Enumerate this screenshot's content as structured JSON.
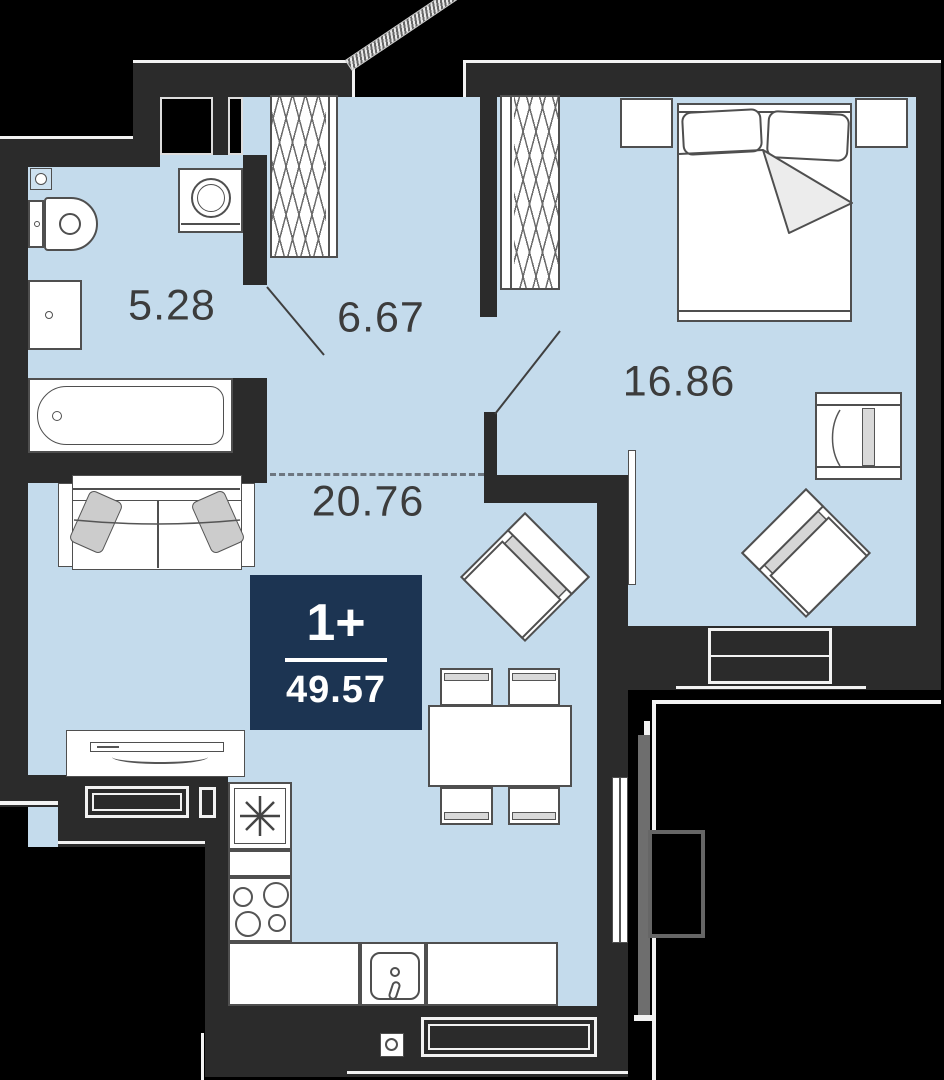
{
  "plan": {
    "badge": {
      "type": "1+",
      "area": "49.57"
    },
    "rooms": [
      {
        "id": "bathroom",
        "area": "5.28"
      },
      {
        "id": "hallway",
        "area": "6.67"
      },
      {
        "id": "bedroom",
        "area": "16.86"
      },
      {
        "id": "living-kitchen",
        "area": "20.76"
      }
    ],
    "colors": {
      "background": "#000000",
      "wall": "#2b2b2b",
      "floor": "#c4dbec",
      "badge": "#1c3452",
      "furniture_stroke": "#4f4f4f",
      "accent_gray": "#d9d9d9",
      "label_text": "#3c3c3c"
    }
  }
}
